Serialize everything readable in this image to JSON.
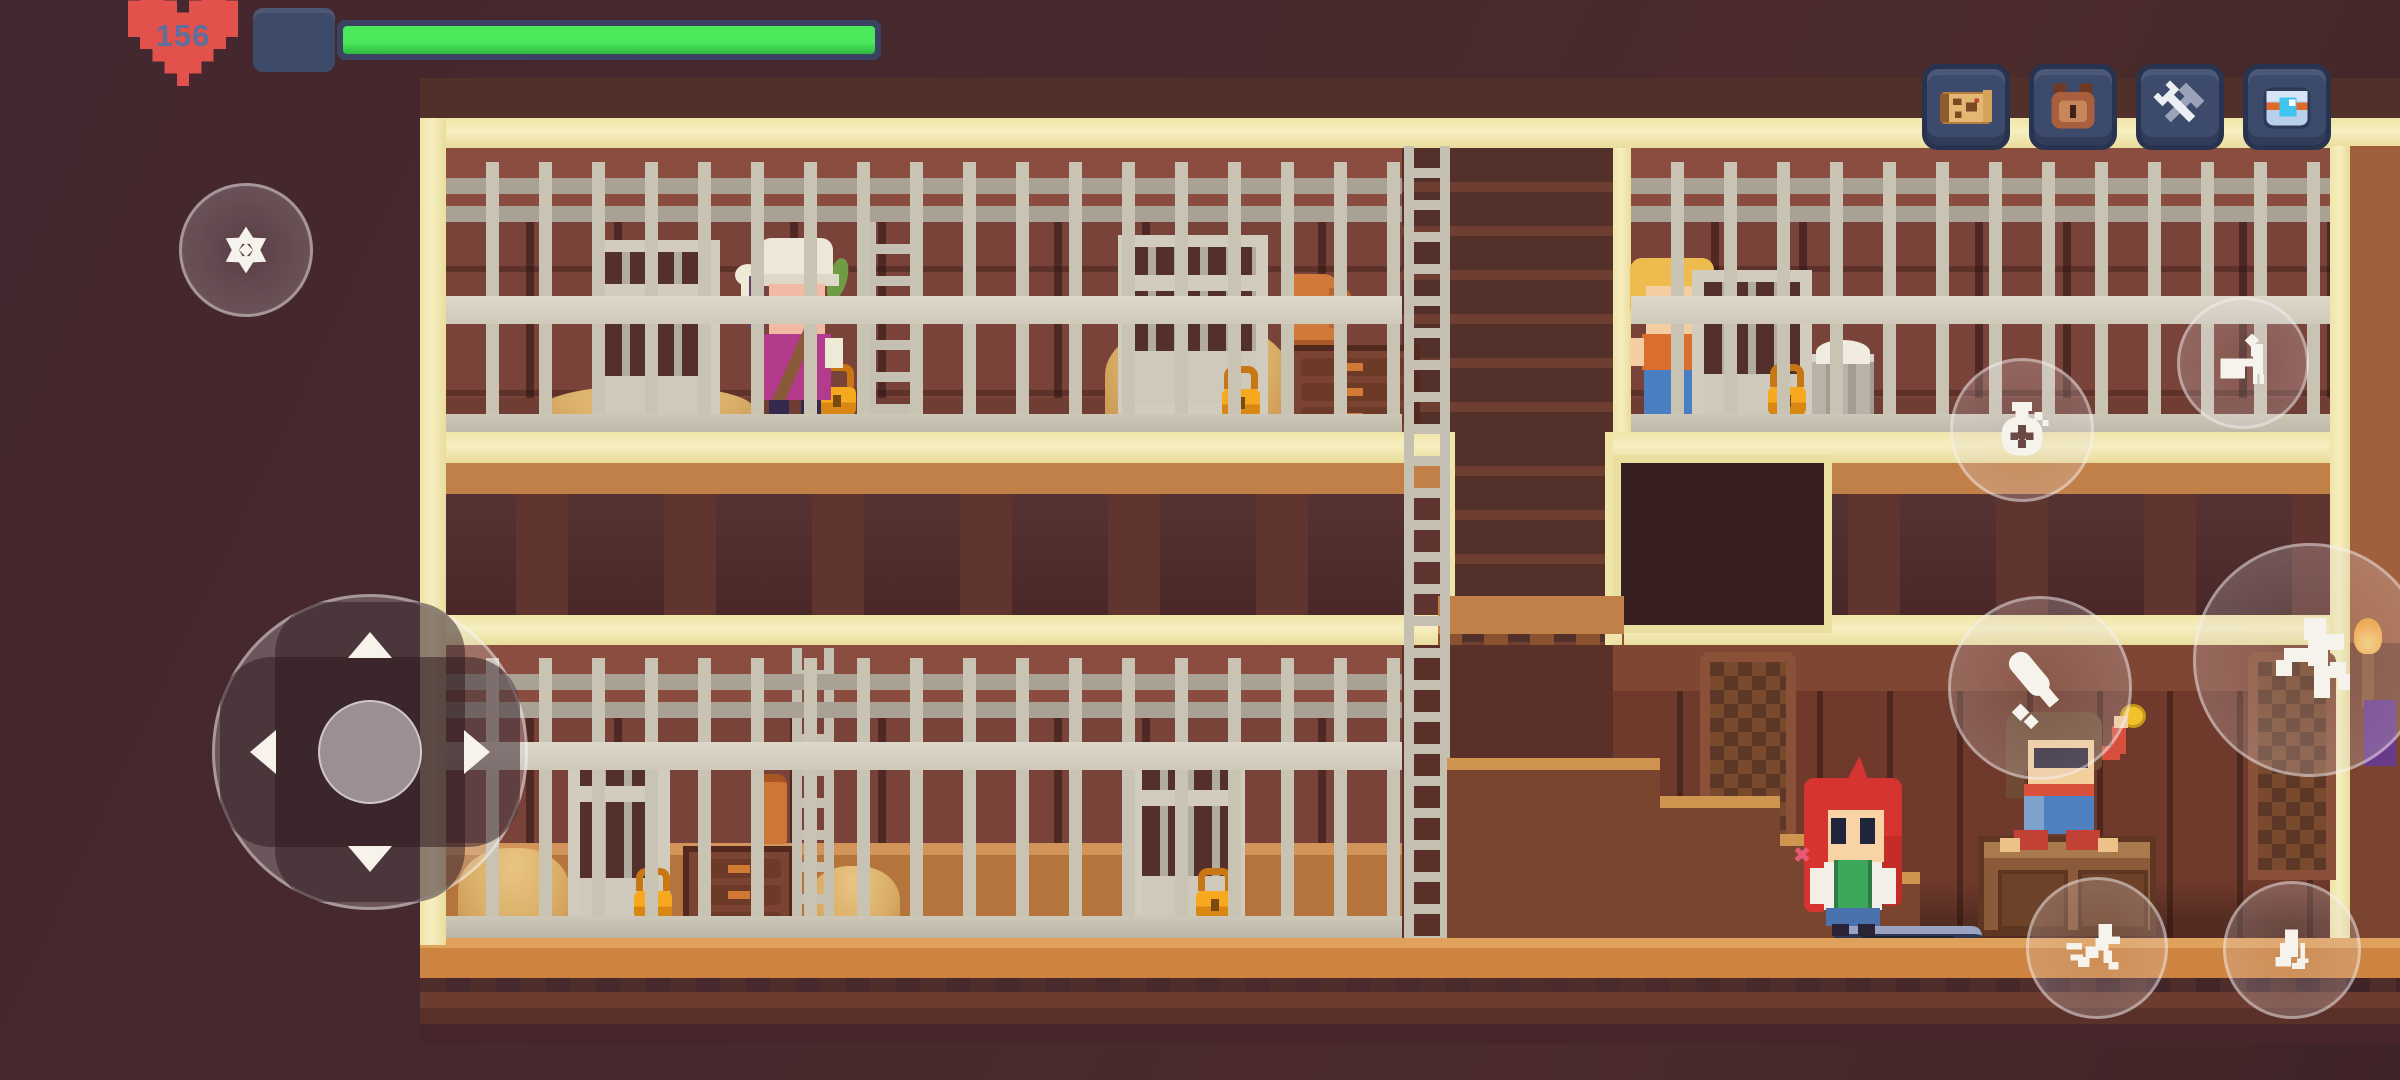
{
  "hud": {
    "health": {
      "value": "156",
      "percent": 100
    },
    "menu_buttons": [
      {
        "name": "map",
        "icon": "map-scroll-icon"
      },
      {
        "name": "inventory",
        "icon": "satchel-icon"
      },
      {
        "name": "crafting",
        "icon": "wrench-hammer-icon"
      },
      {
        "name": "storage",
        "icon": "blue-chest-icon"
      }
    ]
  },
  "touch_controls": {
    "left": [
      {
        "name": "ability-wheel",
        "icon": "wheel-icon"
      },
      {
        "name": "dpad",
        "icons": [
          "arrow-up",
          "arrow-left",
          "arrow-right",
          "arrow-down"
        ]
      }
    ],
    "right": [
      {
        "name": "interact",
        "icon": "person-at-counter-icon"
      },
      {
        "name": "loot",
        "icon": "money-bag-icon"
      },
      {
        "name": "attack",
        "icon": "club-icon"
      },
      {
        "name": "jump",
        "icon": "jumping-figure-icon"
      },
      {
        "name": "dash",
        "icon": "running-figure-icon"
      },
      {
        "name": "crouch",
        "icon": "crouching-figure-icon"
      }
    ]
  },
  "scene": {
    "location": "wooden-prison-interior",
    "entities": [
      "caged-villager-white-hood",
      "caged-cat-jug",
      "caged-villager-blonde",
      "player-red-hair",
      "merchant-on-crate",
      "locked-gate-1",
      "locked-gate-2",
      "locked-gate-3",
      "locked-gate-4",
      "locked-gate-5",
      "hay-piles",
      "ladders",
      "bucket",
      "dressers",
      "clay-jug",
      "lantern",
      "staircase",
      "stair-opening",
      "lattice-doors",
      "wall-torch",
      "blue-stool",
      "wooden-crate"
    ]
  },
  "colors": {
    "heart": "#e2514b",
    "health_fill": "#3bdb4a",
    "health_track": "#3a4462",
    "hud_slot": "#3e4a69",
    "menu_button": "#3c4a6c",
    "glow": "#efe5a8",
    "bars": "#c9c3b4",
    "padlock": "#f6a81f"
  }
}
